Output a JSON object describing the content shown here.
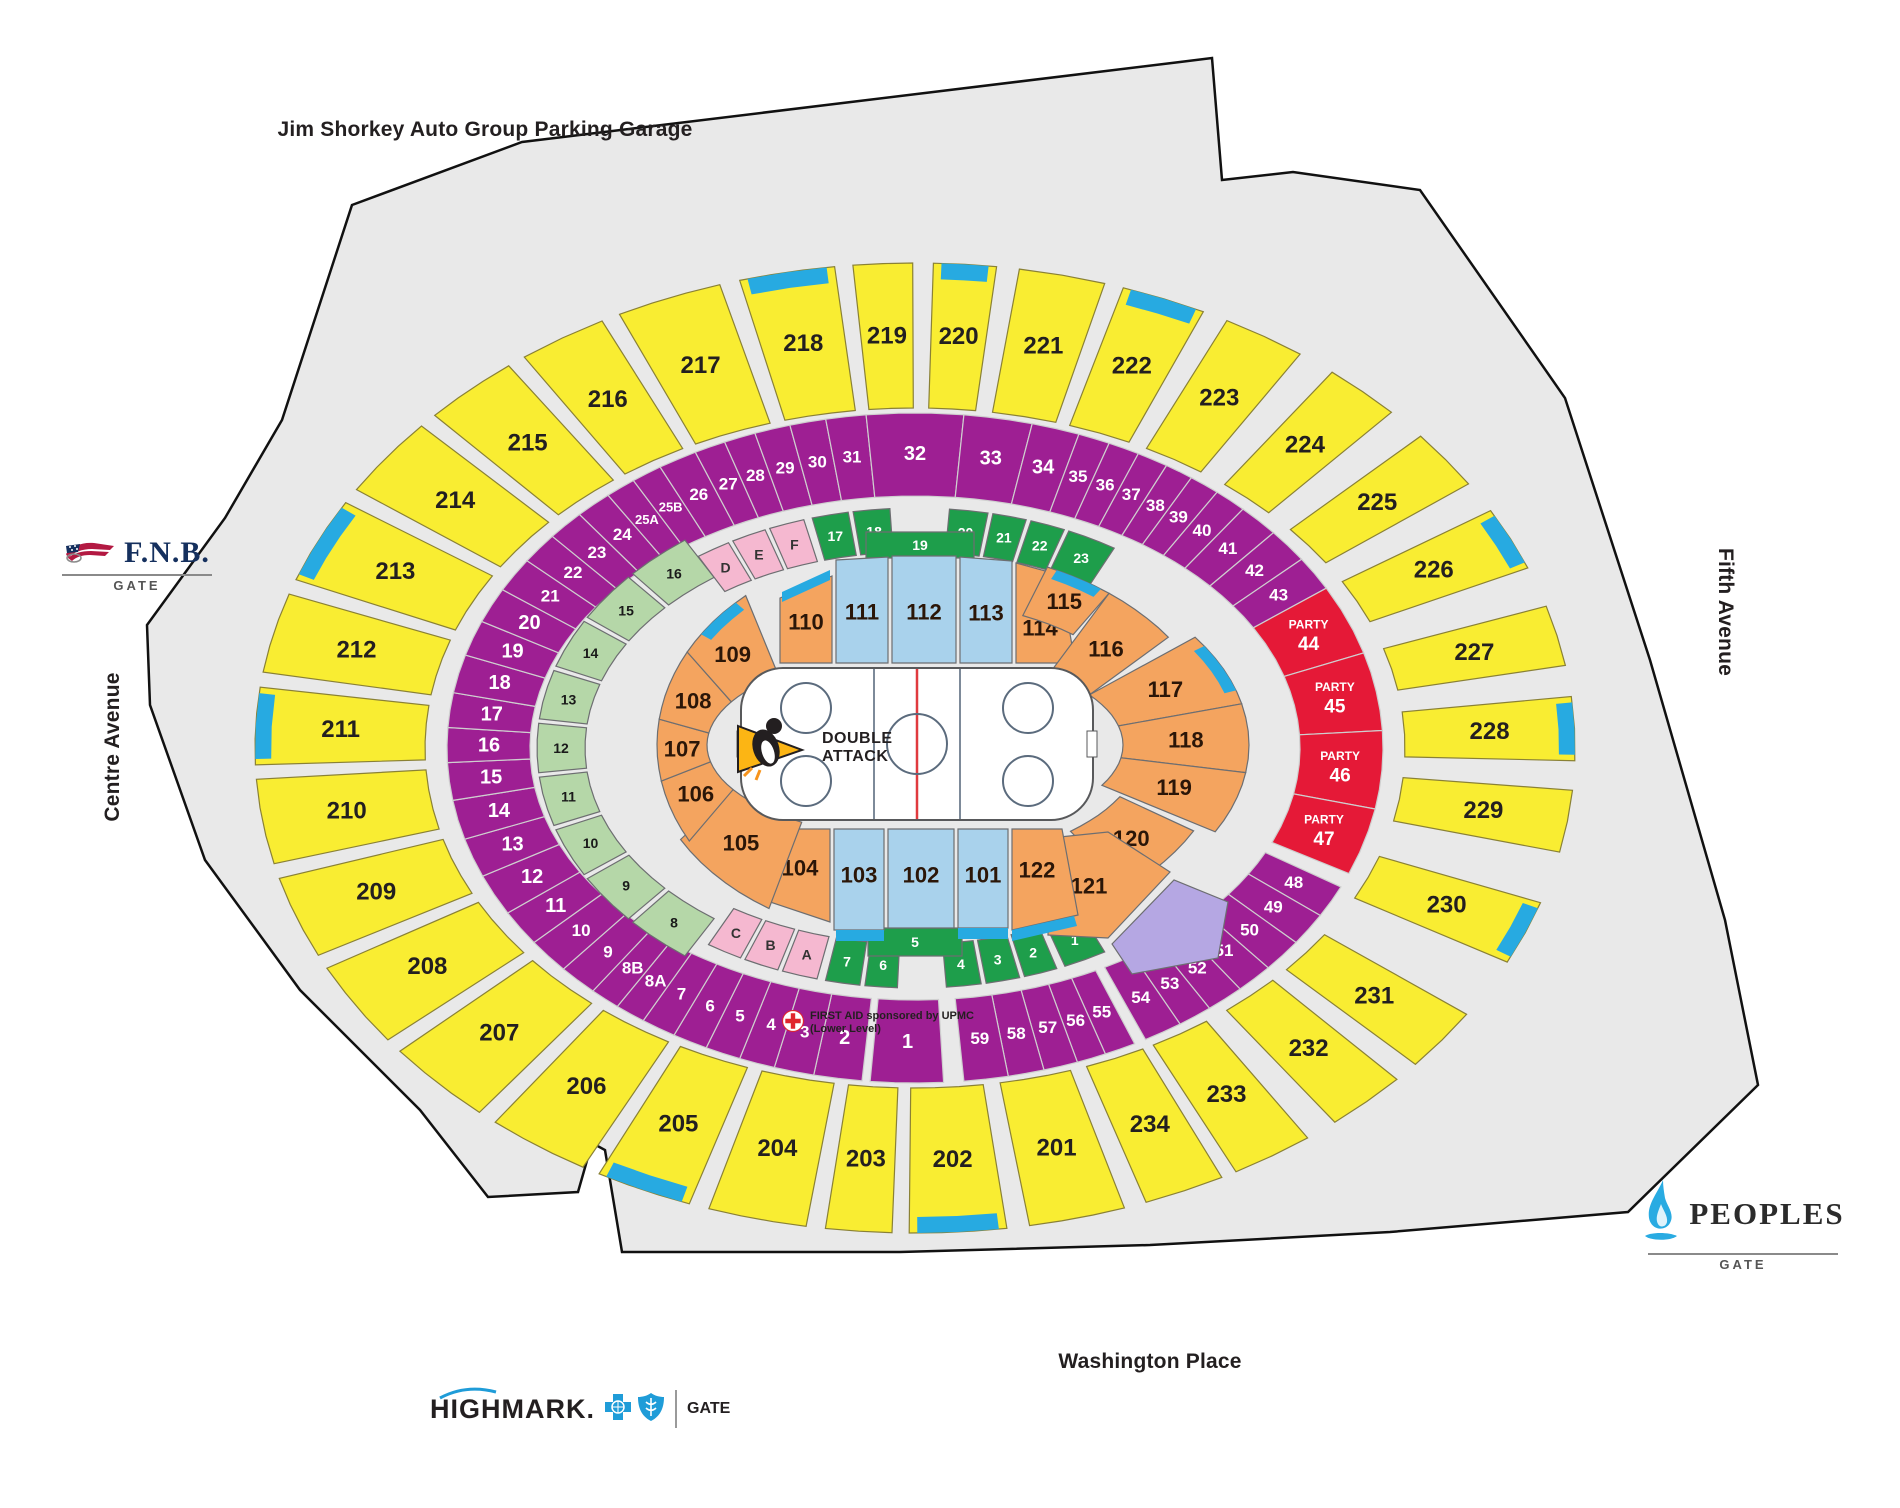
{
  "map_title": {
    "parking_garage": "Jim Shorkey Auto Group Parking Garage",
    "street_left": "Centre Avenue",
    "street_right": "Fifth Avenue",
    "street_bottom": "Washington Place"
  },
  "gates": {
    "fnb": {
      "brand": "F.N.B.",
      "label": "GATE"
    },
    "peoples": {
      "brand": "PEOPLES",
      "label": "GATE"
    },
    "highmark": {
      "brand": "HIGHMARK.",
      "label": "GATE"
    }
  },
  "rink": {
    "promo_line1": "DOUBLE",
    "promo_line2": "ATTACK"
  },
  "first_aid": {
    "line1": "FIRST AID sponsored by UPMC",
    "line2": "(Lower Level)"
  },
  "party_word": "PARTY",
  "sections": {
    "level_200": [
      "201",
      "202",
      "203",
      "204",
      "205",
      "206",
      "207",
      "208",
      "209",
      "210",
      "211",
      "212",
      "213",
      "214",
      "215",
      "216",
      "217",
      "218",
      "219",
      "220",
      "221",
      "222",
      "223",
      "224",
      "225",
      "226",
      "227",
      "228",
      "229",
      "230",
      "231",
      "232",
      "233",
      "234"
    ],
    "ring": [
      "1",
      "2",
      "3",
      "4",
      "5",
      "6",
      "7",
      "8A",
      "8B",
      "9",
      "10",
      "11",
      "12",
      "13",
      "14",
      "15",
      "16",
      "17",
      "18",
      "19",
      "20",
      "21",
      "22",
      "23",
      "24",
      "25A",
      "25B",
      "26",
      "27",
      "28",
      "29",
      "30",
      "31",
      "32",
      "33",
      "34",
      "35",
      "36",
      "37",
      "38",
      "39",
      "40",
      "41",
      "42",
      "43",
      "48",
      "49",
      "50",
      "51",
      "52",
      "53",
      "54",
      "55",
      "56",
      "57",
      "58",
      "59"
    ],
    "party": [
      "44",
      "45",
      "46",
      "47"
    ],
    "level_100": [
      "101",
      "102",
      "103",
      "104",
      "105",
      "106",
      "107",
      "108",
      "109",
      "110",
      "111",
      "112",
      "113",
      "114",
      "115",
      "116",
      "117",
      "118",
      "119",
      "120",
      "121",
      "122"
    ],
    "side_terrace": [
      "8",
      "9",
      "10",
      "11",
      "12",
      "13",
      "14",
      "15",
      "16"
    ],
    "premium_top": [
      "D",
      "E",
      "F",
      "17",
      "18",
      "20",
      "21",
      "22",
      "23",
      "19"
    ],
    "premium_bottom": [
      "C",
      "B",
      "A",
      "7",
      "6",
      "4",
      "3",
      "2",
      "1",
      "5"
    ]
  },
  "colors": {
    "footprint": "#e9e9e9",
    "yellow": "#f9ed32",
    "purple": "#9e1f93",
    "party_red": "#e51937",
    "orange": "#f4a45f",
    "light_blue": "#a9d2ec",
    "aisle_cyan": "#27aae1",
    "light_green": "#b5d7a8",
    "dark_green": "#1e9e4b",
    "pink": "#f5b8d0",
    "lavender": "#b5a7e3",
    "ice_white": "#ffffff",
    "red_line": "#e03a3e",
    "fnb_navy": "#15305e",
    "brand_blue": "#1f9cd8"
  }
}
